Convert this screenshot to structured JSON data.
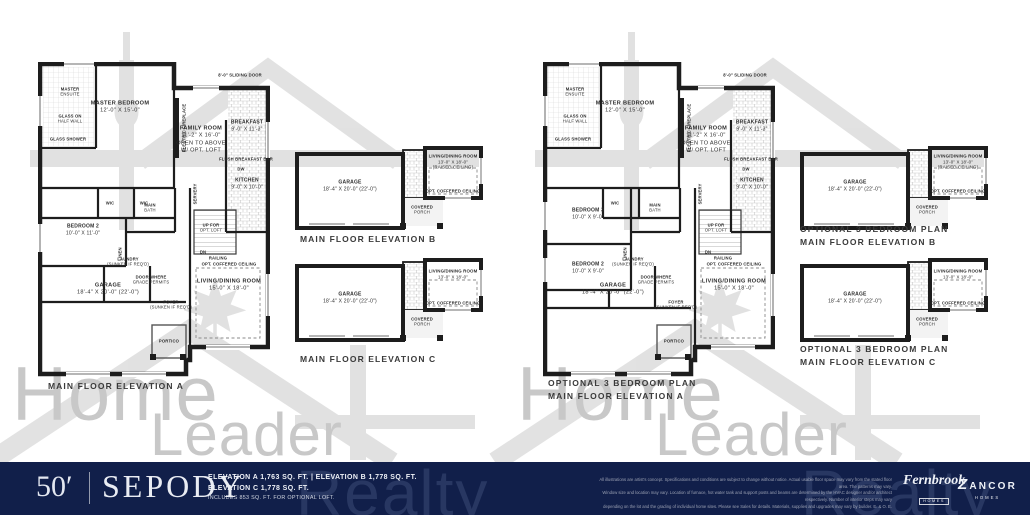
{
  "watermark": {
    "words": [
      "Home",
      "Leader",
      "Realty"
    ],
    "color": "#c8c8c8"
  },
  "panels": [
    {
      "id": "left",
      "main": {
        "caption_lines": [
          "MAIN FLOOR ELEVATION A"
        ],
        "labels": {
          "master_bedroom": [
            "MASTER BEDROOM",
            "12'-0\" X 15'-0\""
          ],
          "master_ensuite": [
            "MASTER",
            "ENSUITE"
          ],
          "glass_half_wall": [
            "GLASS ON",
            "HALF WALL"
          ],
          "glass_shower": [
            "GLASS SHOWER"
          ],
          "family_room": [
            "FAMILY ROOM",
            "11'-2\" X 16'-0\"",
            "OPEN TO ABOVE",
            "W/ OPT. LOFT"
          ],
          "breakfast": [
            "BREAKFAST",
            "9'-0\" X 11'-3\""
          ],
          "kitchen": [
            "KITCHEN",
            "9'-0\" X 10'-0\""
          ],
          "sliding_door": [
            "8'-0\" SLIDING DOOR"
          ],
          "electric_fireplace": [
            "ELECTRIC FIREPLACE"
          ],
          "flush_bar": [
            "FLUSH BREAKFAST BAR"
          ],
          "dw": [
            "DW"
          ],
          "wic_a": [
            "WIC"
          ],
          "wic_b": [
            "WIC"
          ],
          "bedroom2": [
            "BEDROOM 2",
            "10'-0\" X 11'-0\""
          ],
          "main_bath": [
            "MAIN",
            "BATH"
          ],
          "servery": [
            "SERVERY"
          ],
          "linen": [
            "LINEN"
          ],
          "laundry": [
            "LAUNDRY",
            "(SUNKEN IF REQ'D)"
          ],
          "door_grade": [
            "DOOR WHERE",
            "GRADE PERMITS"
          ],
          "up_loft": [
            "UP FOR",
            "OPT. LOFT"
          ],
          "dn": [
            "DN"
          ],
          "railing": [
            "RAILING"
          ],
          "coffered": [
            "OPT. COFFERED CEILING"
          ],
          "living_dining": [
            "LIVING/DINING ROOM",
            "15'-0\" X 18'-0\""
          ],
          "garage": [
            "GARAGE",
            "18'-4\" X 20'-0\" (22'-0\")"
          ],
          "portico": [
            "PORTICO"
          ],
          "foyer": [
            "FOYER",
            "(SUNKEN IF REQ'D)"
          ]
        }
      },
      "planB": {
        "caption_lines": [
          "MAIN FLOOR ELEVATION B"
        ],
        "labels": {
          "garage": [
            "GARAGE",
            "18'-4\" X 20'-0\" (22'-0\")"
          ],
          "living": [
            "LIVING/DINING ROOM",
            "13'-0\" X 18'-0\"",
            "(RAISED CEILING)"
          ],
          "coffered": [
            "OPT. COFFERED CEILING"
          ],
          "porch": [
            "COVERED",
            "PORCH"
          ]
        }
      },
      "planC": {
        "caption_lines": [
          "MAIN FLOOR ELEVATION C"
        ],
        "labels": {
          "garage": [
            "GARAGE",
            "18'-4\" X 20'-0\" (22'-0\")"
          ],
          "living": [
            "LIVING/DINING ROOM",
            "13'-0\" X 18'-0\""
          ],
          "coffered": [
            "OPT. COFFERED CEILING"
          ],
          "porch": [
            "COVERED",
            "PORCH"
          ]
        }
      }
    },
    {
      "id": "right",
      "main": {
        "caption_lines": [
          "OPTIONAL 3 BEDROOM PLAN",
          "MAIN FLOOR ELEVATION A"
        ],
        "labels": {
          "master_bedroom": [
            "MASTER BEDROOM",
            "12'-0\" X 15'-0\""
          ],
          "master_ensuite": [
            "MASTER",
            "ENSUITE"
          ],
          "glass_half_wall": [
            "GLASS ON",
            "HALF WALL"
          ],
          "glass_shower": [
            "GLASS SHOWER"
          ],
          "family_room": [
            "FAMILY ROOM",
            "11'-2\" X 16'-0\"",
            "OPEN TO ABOVE",
            "W/ OPT. LOFT"
          ],
          "breakfast": [
            "BREAKFAST",
            "9'-0\" X 11'-3\""
          ],
          "kitchen": [
            "KITCHEN",
            "9'-0\" X 10'-0\""
          ],
          "sliding_door": [
            "8'-0\" SLIDING DOOR"
          ],
          "electric_fireplace": [
            "ELECTRIC FIREPLACE"
          ],
          "flush_bar": [
            "FLUSH BREAKFAST BAR"
          ],
          "dw": [
            "DW"
          ],
          "wic_a": [
            "WIC"
          ],
          "bedroom3": [
            "BEDROOM 3",
            "10'-0\" X 9'-0\""
          ],
          "bedroom2": [
            "BEDROOM 2",
            "10'-0\" X 9'-0\""
          ],
          "main_bath": [
            "MAIN",
            "BATH"
          ],
          "servery": [
            "SERVERY"
          ],
          "linen": [
            "LINEN"
          ],
          "laundry": [
            "LAUNDRY",
            "(SUNKEN IF REQ'D)"
          ],
          "door_grade": [
            "DOOR WHERE",
            "GRADE PERMITS"
          ],
          "up_loft": [
            "UP FOR",
            "OPT. LOFT"
          ],
          "dn": [
            "DN"
          ],
          "railing": [
            "RAILING"
          ],
          "coffered": [
            "OPT. COFFERED CEILING"
          ],
          "living_dining": [
            "LIVING/DINING ROOM",
            "15'-0\" X 18'-0\""
          ],
          "garage": [
            "GARAGE",
            "18'-4\" X 20'-0\" (22'-0\")"
          ],
          "portico": [
            "PORTICO"
          ],
          "foyer": [
            "FOYER",
            "(SUNKEN IF REQ'D)"
          ]
        }
      },
      "planB": {
        "caption_lines": [
          "OPTIONAL 3 BEDROOM PLAN",
          "MAIN FLOOR ELEVATION B"
        ],
        "labels": {
          "garage": [
            "GARAGE",
            "18'-4\" X 20'-0\" (22'-0\")"
          ],
          "living": [
            "LIVING/DINING ROOM",
            "13'-0\" X 18'-0\"",
            "(RAISED CEILING)"
          ],
          "coffered": [
            "OPT. COFFERED CEILING"
          ],
          "porch": [
            "COVERED",
            "PORCH"
          ]
        }
      },
      "planC": {
        "caption_lines": [
          "OPTIONAL 3 BEDROOM PLAN",
          "MAIN FLOOR ELEVATION C"
        ],
        "labels": {
          "garage": [
            "GARAGE",
            "18'-4\" X 20'-0\" (22'-0\")"
          ],
          "living": [
            "LIVING/DINING ROOM",
            "13'-0\" X 18'-0\""
          ],
          "coffered": [
            "OPT. COFFERED CEILING"
          ],
          "porch": [
            "COVERED",
            "PORCH"
          ]
        }
      }
    }
  ],
  "footer": {
    "bg_color": "#111f4a",
    "lot_size": "50′",
    "model_name": "SEPODY",
    "elevation_line1": "ELEVATION A 1,763 SQ. FT.  |  ELEVATION B 1,778 SQ. FT.",
    "elevation_line2": "ELEVATION C 1,778 SQ. FT.",
    "elevation_line3": "INCLUDES 853 SQ. FT. FOR OPTIONAL LOFT.",
    "disclaimer_lines": [
      "All illustrations are artist's concept. Specifications and conditions are subject to change without notice. Actual usable floor space may vary from the stated floor area. The patterns may vary.",
      "Window size and location may vary. Location of furnace, hot water tank and support posts and beams are determined by the HVAC designer and/or architect respectively. Number of interior steps may vary",
      "depending on the lot and the grading of individual home sites. Please see Sales for details. Materials, supplies and upgrades may vary by builder. E. & O. E."
    ],
    "builder_logos": [
      {
        "name": "Fernbrook",
        "sub": "HOMES"
      },
      {
        "name": "ZANCOR",
        "sub": "HOMES"
      }
    ]
  }
}
